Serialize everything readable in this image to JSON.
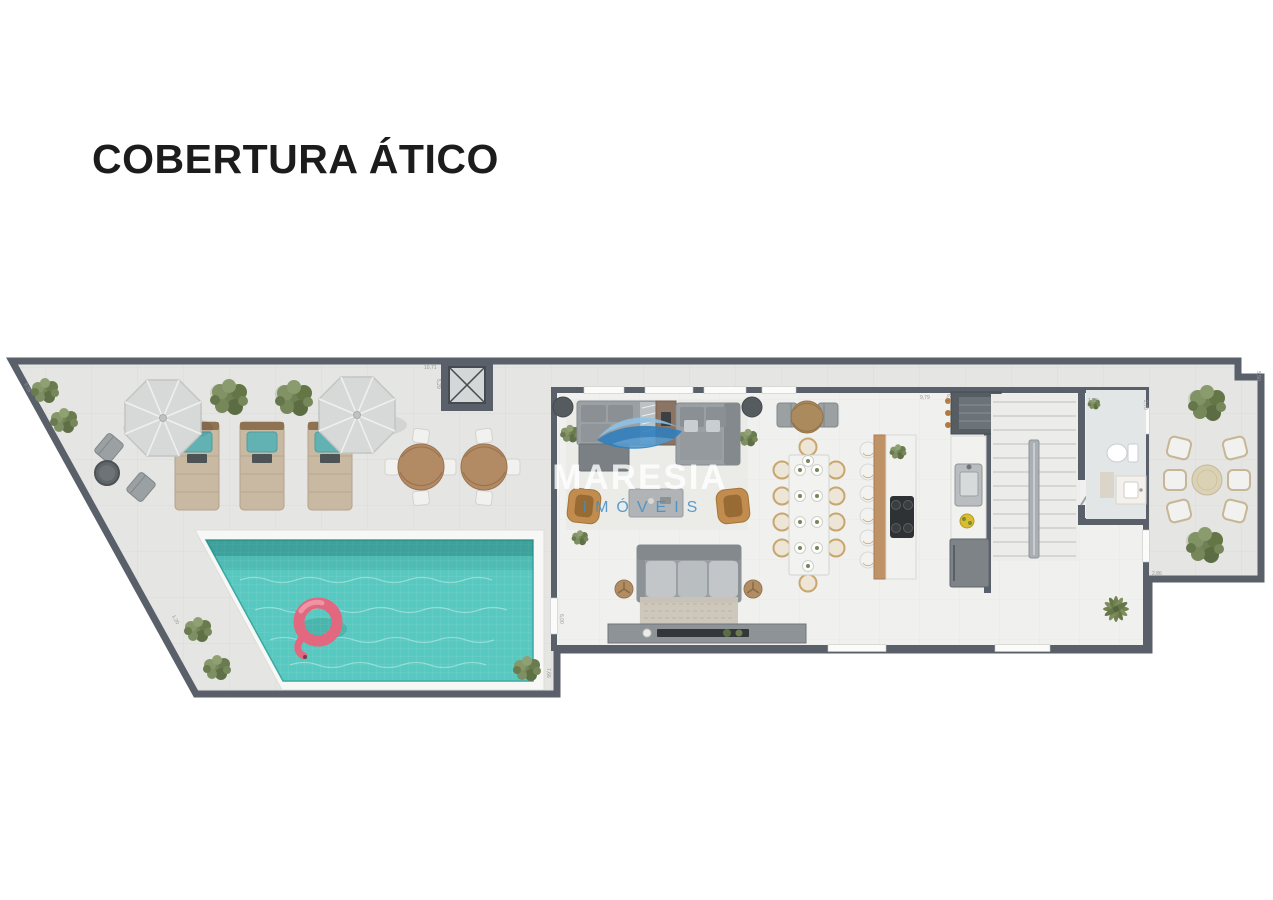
{
  "page": {
    "title": "COBERTURA ÁTICO"
  },
  "watermark": {
    "brand": "MARESIA",
    "subtitle": "IMÓVEIS",
    "logo_icon": "wave-icon"
  },
  "floor_plan": {
    "label": "penthouse-attic-floor-plan",
    "areas": [
      "pool-deck",
      "swimming-pool",
      "living-room",
      "dining-area",
      "kitchen",
      "staircase",
      "bathroom",
      "terrace",
      "elevator-hall"
    ],
    "dimensions": [
      {
        "value": "9,55",
        "edge": "top-left-diagonal"
      },
      {
        "value": "10,71",
        "edge": "elevator-top"
      },
      {
        "value": "5,29",
        "edge": "elevator-side"
      },
      {
        "value": "9,79",
        "edge": "kitchen-top"
      },
      {
        "value": "6,75",
        "edge": "kitchen-top-side"
      },
      {
        "value": "1,50",
        "edge": "bathroom-top"
      },
      {
        "value": "2,70",
        "edge": "bathroom-side"
      },
      {
        "value": "5,50",
        "edge": "right-edge"
      },
      {
        "value": "2,86",
        "edge": "terrace-step"
      },
      {
        "value": "6,00",
        "edge": "living-left-wall"
      },
      {
        "value": "7,66",
        "edge": "pool-right"
      },
      {
        "value": "1,20",
        "edge": "pool-diagonal"
      }
    ],
    "furniture": [
      "swimming-pool",
      "flamingo-float",
      "parasol-umbrella-x2",
      "sun-lounger-x3",
      "bistro-chairs",
      "round-side-table",
      "round-wood-table-x2",
      "white-deck-chairs",
      "elevator",
      "sectional-sofa",
      "lounge-sofa",
      "console-table",
      "armchair-x2",
      "coffee-table",
      "three-seat-sofa",
      "tv-console",
      "area-rug",
      "round-bistro-table",
      "dining-table-10-seats",
      "kitchen-island",
      "bar-stools-x6",
      "cooktop",
      "sink-counter",
      "refrigerator",
      "grill-counter",
      "staircase",
      "toilet",
      "bathroom-vanity",
      "terrace-dining-table",
      "terrace-chairs-x6",
      "trees-and-planters"
    ],
    "colors": {
      "title": "#1c1c1c",
      "wall": "#59606a",
      "deck": "#e5e5e3",
      "indoor": "#f0f0ee",
      "pool": "#57c9c0",
      "coping": "#f7f7f5",
      "umbrella": "#d7d9d8",
      "lounger": "#c9b8a2",
      "pillow": "#62b2b4",
      "wood": "#b28a63",
      "sofa": "#9aa0a4",
      "sofa_dark": "#84898d",
      "armchair": "#c18c4d",
      "chair": "#f1f1ef",
      "green": "#76875a",
      "pink": "#e26880",
      "wmblue": "#3f8fc9",
      "dim": "#97979a",
      "marble": "#f1f1ef",
      "fridge": "#7e8388",
      "rug": "#cbc5b8"
    }
  }
}
